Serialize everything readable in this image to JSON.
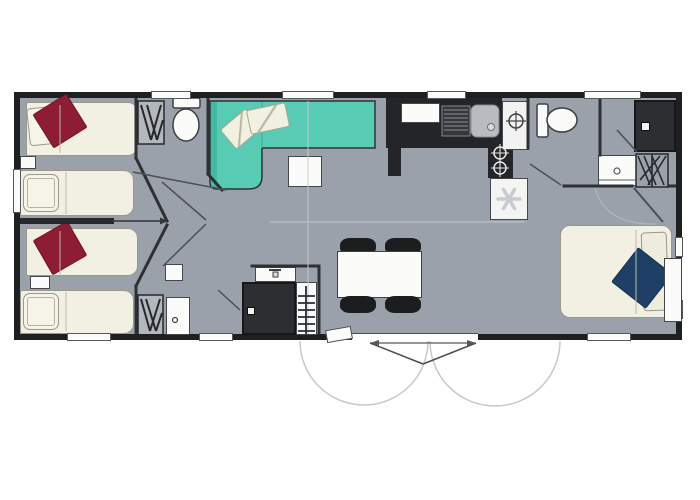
{
  "drawing": {
    "kind": "mobile-home floor plan, top view, no text labels",
    "colors": {
      "background": "#ffffff",
      "floor": "#9aa1ab",
      "wall": "#1d1f21",
      "wall_inner": "#2e3134",
      "bed": "#f2f0e2",
      "bed_border": "#9a988a",
      "cushion_red": "#8e1c33",
      "cushion_navy": "#1e4066",
      "sofa": "#57cbb4",
      "sofa_shade": "#3db59e",
      "unit_dark": "#232528",
      "fixture": "#fbfbfa",
      "line_swing": "#4c4f54",
      "line_faint": "#c5c8cc"
    },
    "rooms": [
      {
        "name": "twin-bedroom-1",
        "items": [
          "single-bed",
          "single-bed",
          "red-cushion",
          "pillow",
          "nightstand",
          "wardrobe"
        ]
      },
      {
        "name": "twin-bedroom-2",
        "items": [
          "single-bed",
          "single-bed",
          "red-cushion",
          "pillow",
          "shelf",
          "wardrobe",
          "door-leaf"
        ]
      },
      {
        "name": "wc-front",
        "items": [
          "toilet"
        ]
      },
      {
        "name": "living-room",
        "items": [
          "corner-sofa",
          "sofa-pillow",
          "sofa-pillow",
          "coffee-table"
        ]
      },
      {
        "name": "kitchen",
        "items": [
          "counter",
          "cupboard",
          "sink-with-drainer",
          "two-burner-hob",
          "single-burner-unit",
          "fridge-with-snowflake"
        ]
      },
      {
        "name": "wc-rear",
        "items": [
          "toilet"
        ]
      },
      {
        "name": "bathroom-rear",
        "items": [
          "shower",
          "washbasin",
          "wardrobe"
        ]
      },
      {
        "name": "master-bedroom",
        "items": [
          "double-bed",
          "navy-cushion",
          "pillow",
          "nightstand"
        ]
      },
      {
        "name": "shower-room-front",
        "items": [
          "washbasin",
          "shower-cabin",
          "towel-radiator"
        ]
      },
      {
        "name": "dining-area",
        "items": [
          "table",
          "chair",
          "chair",
          "chair",
          "chair"
        ]
      },
      {
        "name": "entrance",
        "items": [
          "double-door",
          "swing-arcs",
          "step"
        ]
      }
    ],
    "window_count": 10,
    "icons": [
      "snowflake-icon",
      "burner-icon",
      "drain-icon",
      "shower-head-icon"
    ]
  }
}
